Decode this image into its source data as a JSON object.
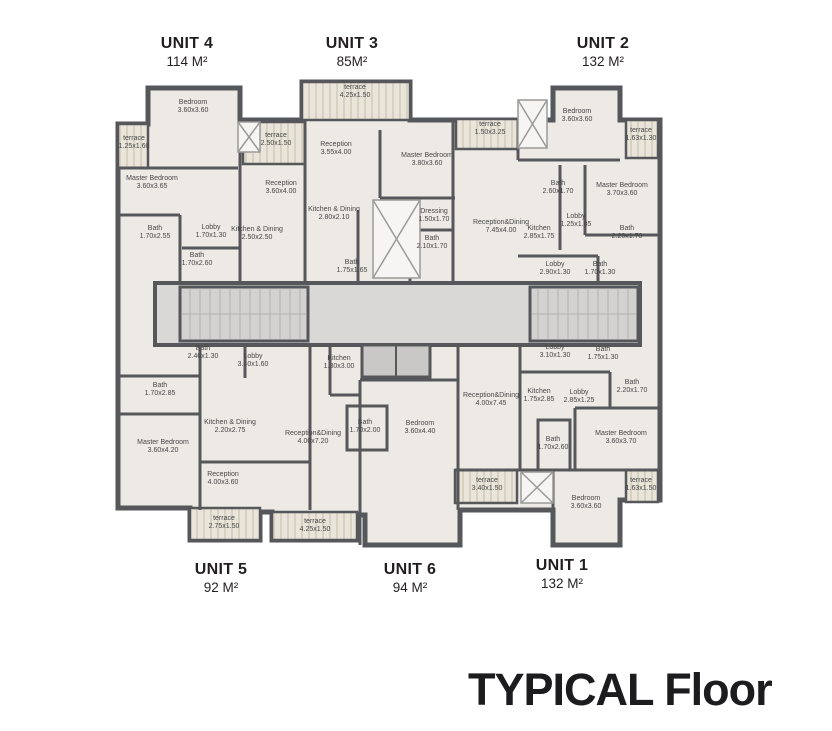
{
  "title": {
    "text": "TYPICAL Floor"
  },
  "colors": {
    "wall": "#56575b",
    "floor": "#edeae5",
    "corridor": "#d9d8d6",
    "terrace": "#eae5da",
    "text": "#231f20"
  },
  "units": [
    {
      "name": "UNIT 4",
      "area": "114 M²"
    },
    {
      "name": "UNIT 3",
      "area": "85M²"
    },
    {
      "name": "UNIT 2",
      "area": "132 M²"
    },
    {
      "name": "UNIT 5",
      "area": "92 M²"
    },
    {
      "name": "UNIT 6",
      "area": "94 M²"
    },
    {
      "name": "UNIT 1",
      "area": "132 M²"
    }
  ],
  "rooms": [
    {
      "unit": "4",
      "name": "Bedroom",
      "dims": "3.60x3.60",
      "x": 193,
      "y": 107
    },
    {
      "unit": "4",
      "name": "terrace",
      "dims": "1.25x1.60",
      "x": 134,
      "y": 143
    },
    {
      "unit": "4",
      "name": "terrace",
      "dims": "2.50x1.50",
      "x": 276,
      "y": 140
    },
    {
      "unit": "4",
      "name": "Master Bedroom",
      "dims": "3.60x3.65",
      "x": 152,
      "y": 183
    },
    {
      "unit": "4",
      "name": "Reception",
      "dims": "3.60x4.00",
      "x": 281,
      "y": 188
    },
    {
      "unit": "4",
      "name": "Bath",
      "dims": "1.70x2.55",
      "x": 155,
      "y": 233
    },
    {
      "unit": "4",
      "name": "Lobby",
      "dims": "1.70x1.30",
      "x": 211,
      "y": 232
    },
    {
      "unit": "4",
      "name": "Kitchen & Dining",
      "dims": "2.50x2.50",
      "x": 257,
      "y": 234
    },
    {
      "unit": "4",
      "name": "Bath",
      "dims": "1.70x2.60",
      "x": 197,
      "y": 260
    },
    {
      "unit": "3",
      "name": "terrace",
      "dims": "4.25x1.50",
      "x": 355,
      "y": 92
    },
    {
      "unit": "3",
      "name": "Reception",
      "dims": "3.55x4.00",
      "x": 336,
      "y": 149
    },
    {
      "unit": "3",
      "name": "Master Bedroom",
      "dims": "3.80x3.60",
      "x": 427,
      "y": 160
    },
    {
      "unit": "3",
      "name": "Kitchen & Dining",
      "dims": "2.80x2.10",
      "x": 334,
      "y": 214
    },
    {
      "unit": "3",
      "name": "Dressing",
      "dims": "1.50x1.70",
      "x": 434,
      "y": 216
    },
    {
      "unit": "3",
      "name": "Bath",
      "dims": "2.10x1.70",
      "x": 432,
      "y": 243
    },
    {
      "unit": "3",
      "name": "Bath",
      "dims": "1.75x1.65",
      "x": 352,
      "y": 267
    },
    {
      "unit": "2",
      "name": "Bedroom",
      "dims": "3.60x3.60",
      "x": 577,
      "y": 116
    },
    {
      "unit": "2",
      "name": "terrace",
      "dims": "1.50x3.25",
      "x": 490,
      "y": 129
    },
    {
      "unit": "2",
      "name": "terrace",
      "dims": "1.63x1.30",
      "x": 641,
      "y": 135
    },
    {
      "unit": "2",
      "name": "Bath",
      "dims": "2.60x1.70",
      "x": 558,
      "y": 188
    },
    {
      "unit": "2",
      "name": "Master Bedroom",
      "dims": "3.70x3.60",
      "x": 622,
      "y": 190
    },
    {
      "unit": "2",
      "name": "Reception&Dining",
      "dims": "7.45x4.00",
      "x": 501,
      "y": 227
    },
    {
      "unit": "2",
      "name": "Kitchen",
      "dims": "2.85x1.75",
      "x": 539,
      "y": 233
    },
    {
      "unit": "2",
      "name": "Lobby",
      "dims": "1.25x1.85",
      "x": 576,
      "y": 221
    },
    {
      "unit": "2",
      "name": "Bath",
      "dims": "2.20x1.70",
      "x": 627,
      "y": 233
    },
    {
      "unit": "2",
      "name": "Lobby",
      "dims": "2.90x1.30",
      "x": 555,
      "y": 269
    },
    {
      "unit": "2",
      "name": "Bath",
      "dims": "1.70x1.30",
      "x": 600,
      "y": 269
    },
    {
      "unit": "5",
      "name": "Bath",
      "dims": "2.40x1.30",
      "x": 203,
      "y": 353
    },
    {
      "unit": "5",
      "name": "Lobby",
      "dims": "3.40x1.60",
      "x": 253,
      "y": 361
    },
    {
      "unit": "5",
      "name": "Bath",
      "dims": "1.70x2.85",
      "x": 160,
      "y": 390
    },
    {
      "unit": "5",
      "name": "Master Bedroom",
      "dims": "3.60x4.20",
      "x": 163,
      "y": 447
    },
    {
      "unit": "5",
      "name": "Kitchen & Dining",
      "dims": "2.20x2.75",
      "x": 230,
      "y": 427
    },
    {
      "unit": "5",
      "name": "Reception",
      "dims": "4.00x3.60",
      "x": 223,
      "y": 479
    },
    {
      "unit": "5",
      "name": "terrace",
      "dims": "2.75x1.50",
      "x": 224,
      "y": 523
    },
    {
      "unit": "6",
      "name": "Kitchen",
      "dims": "1.30x3.00",
      "x": 339,
      "y": 363
    },
    {
      "unit": "6",
      "name": "Bath",
      "dims": "1.70x2.00",
      "x": 365,
      "y": 427
    },
    {
      "unit": "6",
      "name": "Reception&Dining",
      "dims": "4.00x7.20",
      "x": 313,
      "y": 438
    },
    {
      "unit": "6",
      "name": "Bedroom",
      "dims": "3.60x4.40",
      "x": 420,
      "y": 428
    },
    {
      "unit": "6",
      "name": "terrace",
      "dims": "4.25x1.50",
      "x": 315,
      "y": 526
    },
    {
      "unit": "1",
      "name": "Lobby",
      "dims": "3.10x1.30",
      "x": 555,
      "y": 352
    },
    {
      "unit": "1",
      "name": "Bath",
      "dims": "1.75x1.30",
      "x": 603,
      "y": 354
    },
    {
      "unit": "1",
      "name": "Kitchen",
      "dims": "1.75x2.85",
      "x": 539,
      "y": 396
    },
    {
      "unit": "1",
      "name": "Lobby",
      "dims": "2.85x1.25",
      "x": 579,
      "y": 397
    },
    {
      "unit": "1",
      "name": "Bath",
      "dims": "2.20x1.70",
      "x": 632,
      "y": 387
    },
    {
      "unit": "1",
      "name": "Reception&Dining",
      "dims": "4.00x7.45",
      "x": 491,
      "y": 400
    },
    {
      "unit": "1",
      "name": "Master Bedroom",
      "dims": "3.60x3.70",
      "x": 621,
      "y": 438
    },
    {
      "unit": "1",
      "name": "Bath",
      "dims": "1.70x2.60",
      "x": 553,
      "y": 444
    },
    {
      "unit": "1",
      "name": "terrace",
      "dims": "3.40x1.50",
      "x": 487,
      "y": 485
    },
    {
      "unit": "1",
      "name": "terrace",
      "dims": "1.63x1.50",
      "x": 641,
      "y": 485
    },
    {
      "unit": "1",
      "name": "Bedroom",
      "dims": "3.60x3.60",
      "x": 586,
      "y": 503
    }
  ]
}
